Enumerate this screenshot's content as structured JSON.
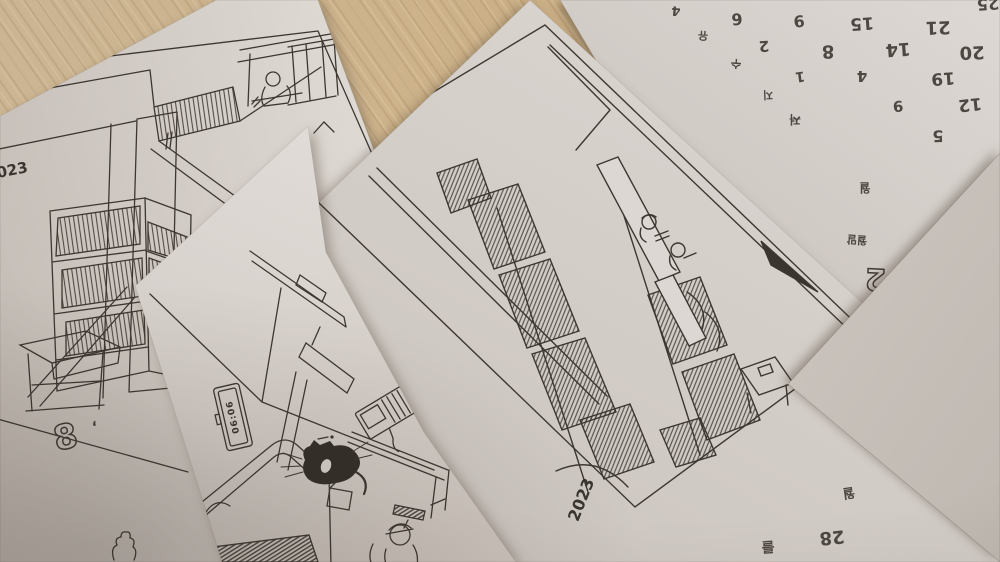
{
  "palette": {
    "wood": "#c9ad83",
    "paper": "#d9d3cd",
    "ink": "#3b352f"
  },
  "papers": {
    "storyboard_room": {
      "year_label": "2023",
      "page_number": "8",
      "notes": [
        {
          "text": "ʻ",
          "x": 95,
          "y": 427,
          "rot": -14,
          "size": 15
        }
      ]
    },
    "sketch_bedroom": {
      "clock_time": "06:06"
    },
    "sketch_library_aisle": {
      "year_label": "2023",
      "margin_notes": [
        {
          "text": "월",
          "x": 849,
          "y": 494,
          "rot": 172,
          "size": 13
        },
        {
          "text": "28",
          "x": 832,
          "y": 537,
          "rot": 174,
          "size": 18
        },
        {
          "text": "를",
          "x": 768,
          "y": 547,
          "rot": 176,
          "size": 14
        }
      ]
    },
    "calendar_sheet": {
      "page_number": "2",
      "entries": [
        {
          "text": "4",
          "x": 676,
          "y": 10,
          "rot": 184,
          "size": 13
        },
        {
          "text": "6",
          "x": 737,
          "y": 19,
          "rot": 176,
          "size": 16
        },
        {
          "text": "9",
          "x": 799,
          "y": 21,
          "rot": 174,
          "size": 16
        },
        {
          "text": "15",
          "x": 862,
          "y": 23,
          "rot": 176,
          "size": 17
        },
        {
          "text": "21",
          "x": 938,
          "y": 27,
          "rot": 178,
          "size": 18
        },
        {
          "text": "25",
          "x": 988,
          "y": 4,
          "rot": 176,
          "size": 16
        },
        {
          "text": "유",
          "x": 703,
          "y": 36,
          "rot": 182,
          "size": 11
        },
        {
          "text": "2",
          "x": 764,
          "y": 46,
          "rot": 176,
          "size": 15
        },
        {
          "text": "8",
          "x": 828,
          "y": 51,
          "rot": 178,
          "size": 18
        },
        {
          "text": "14",
          "x": 898,
          "y": 49,
          "rot": 176,
          "size": 18
        },
        {
          "text": "20",
          "x": 972,
          "y": 52,
          "rot": 178,
          "size": 18
        },
        {
          "text": "수",
          "x": 736,
          "y": 64,
          "rot": 184,
          "size": 11,
          "cls": "strike"
        },
        {
          "text": "1",
          "x": 800,
          "y": 76,
          "rot": 172,
          "size": 14
        },
        {
          "text": "4",
          "x": 862,
          "y": 76,
          "rot": 180,
          "size": 15
        },
        {
          "text": "19",
          "x": 943,
          "y": 78,
          "rot": 176,
          "size": 17
        },
        {
          "text": "지",
          "x": 768,
          "y": 95,
          "rot": 178,
          "size": 11
        },
        {
          "text": "9",
          "x": 898,
          "y": 106,
          "rot": 176,
          "size": 15
        },
        {
          "text": "12",
          "x": 970,
          "y": 104,
          "rot": 174,
          "size": 17
        },
        {
          "text": "저",
          "x": 795,
          "y": 120,
          "rot": 180,
          "size": 12,
          "cls": "strike"
        },
        {
          "text": "5",
          "x": 938,
          "y": 136,
          "rot": 178,
          "size": 16
        },
        {
          "text": "월",
          "x": 865,
          "y": 188,
          "rot": 180,
          "size": 12
        },
        {
          "text": "월말",
          "x": 857,
          "y": 240,
          "rot": 184,
          "size": 11
        }
      ]
    },
    "blank_corner_sheet": {}
  }
}
